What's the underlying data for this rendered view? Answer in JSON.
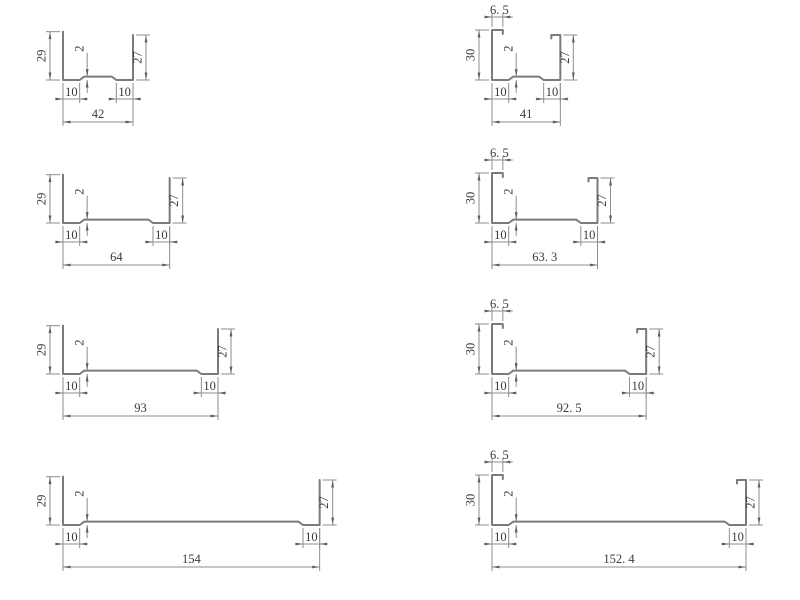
{
  "drawing": {
    "background": "#ffffff",
    "profile_line_color": "#7b7b7b",
    "dimension_line_color": "#8e8e8e",
    "arrow_color": "#5f5f5f",
    "text_color": "#3a3a3a",
    "profiles": [
      {
        "name": "profile-42",
        "column": "left",
        "row": 1,
        "type": "plain",
        "dimensions": {
          "overall_width": 42,
          "left_leg_height": 29,
          "right_leg_height": 27,
          "flange_left": 10,
          "flange_right": 10,
          "web_step": 2
        },
        "labels": {
          "width": "42",
          "left_height": "29",
          "right_height": "27",
          "flange_left": "10",
          "flange_right": "10",
          "step": "2"
        }
      },
      {
        "name": "profile-41",
        "column": "right",
        "row": 1,
        "type": "lipped",
        "dimensions": {
          "overall_width": 41,
          "left_leg_height": 30,
          "right_leg_height": 27,
          "flange_left": 10,
          "flange_right": 10,
          "web_step": 2,
          "top_lip": 6.5
        },
        "labels": {
          "width": "41",
          "left_height": "30",
          "right_height": "27",
          "flange_left": "10",
          "flange_right": "10",
          "step": "2",
          "lip": "6. 5"
        }
      },
      {
        "name": "profile-64",
        "column": "left",
        "row": 2,
        "type": "plain",
        "dimensions": {
          "overall_width": 64,
          "left_leg_height": 29,
          "right_leg_height": 27,
          "flange_left": 10,
          "flange_right": 10,
          "web_step": 2
        },
        "labels": {
          "width": "64",
          "left_height": "29",
          "right_height": "27",
          "flange_left": "10",
          "flange_right": "10",
          "step": "2"
        }
      },
      {
        "name": "profile-63-3",
        "column": "right",
        "row": 2,
        "type": "lipped",
        "dimensions": {
          "overall_width": 63.3,
          "left_leg_height": 30,
          "right_leg_height": 27,
          "flange_left": 10,
          "flange_right": 10,
          "web_step": 2,
          "top_lip": 6.5
        },
        "labels": {
          "width": "63. 3",
          "left_height": "30",
          "right_height": "27",
          "flange_left": "10",
          "flange_right": "10",
          "step": "2",
          "lip": "6. 5"
        }
      },
      {
        "name": "profile-93",
        "column": "left",
        "row": 3,
        "type": "plain",
        "dimensions": {
          "overall_width": 93,
          "left_leg_height": 29,
          "right_leg_height": 27,
          "flange_left": 10,
          "flange_right": 10,
          "web_step": 2
        },
        "labels": {
          "width": "93",
          "left_height": "29",
          "right_height": "27",
          "flange_left": "10",
          "flange_right": "10",
          "step": "2"
        }
      },
      {
        "name": "profile-92-5",
        "column": "right",
        "row": 3,
        "type": "lipped",
        "dimensions": {
          "overall_width": 92.5,
          "left_leg_height": 30,
          "right_leg_height": 27,
          "flange_left": 10,
          "flange_right": 10,
          "web_step": 2,
          "top_lip": 6.5
        },
        "labels": {
          "width": "92. 5",
          "left_height": "30",
          "right_height": "27",
          "flange_left": "10",
          "flange_right": "10",
          "step": "2",
          "lip": "6. 5"
        }
      },
      {
        "name": "profile-154",
        "column": "left",
        "row": 4,
        "type": "plain",
        "dimensions": {
          "overall_width": 154,
          "left_leg_height": 29,
          "right_leg_height": 27,
          "flange_left": 10,
          "flange_right": 10,
          "web_step": 2
        },
        "labels": {
          "width": "154",
          "left_height": "29",
          "right_height": "27",
          "flange_left": "10",
          "flange_right": "10",
          "step": "2"
        }
      },
      {
        "name": "profile-152-4",
        "column": "right",
        "row": 4,
        "type": "lipped",
        "dimensions": {
          "overall_width": 152.4,
          "left_leg_height": 30,
          "right_leg_height": 27,
          "flange_left": 10,
          "flange_right": 10,
          "web_step": 2,
          "top_lip": 6.5
        },
        "labels": {
          "width": "152. 4",
          "left_height": "30",
          "right_height": "27",
          "flange_left": "10",
          "flange_right": "10",
          "step": "2",
          "lip": "6. 5"
        }
      }
    ]
  }
}
